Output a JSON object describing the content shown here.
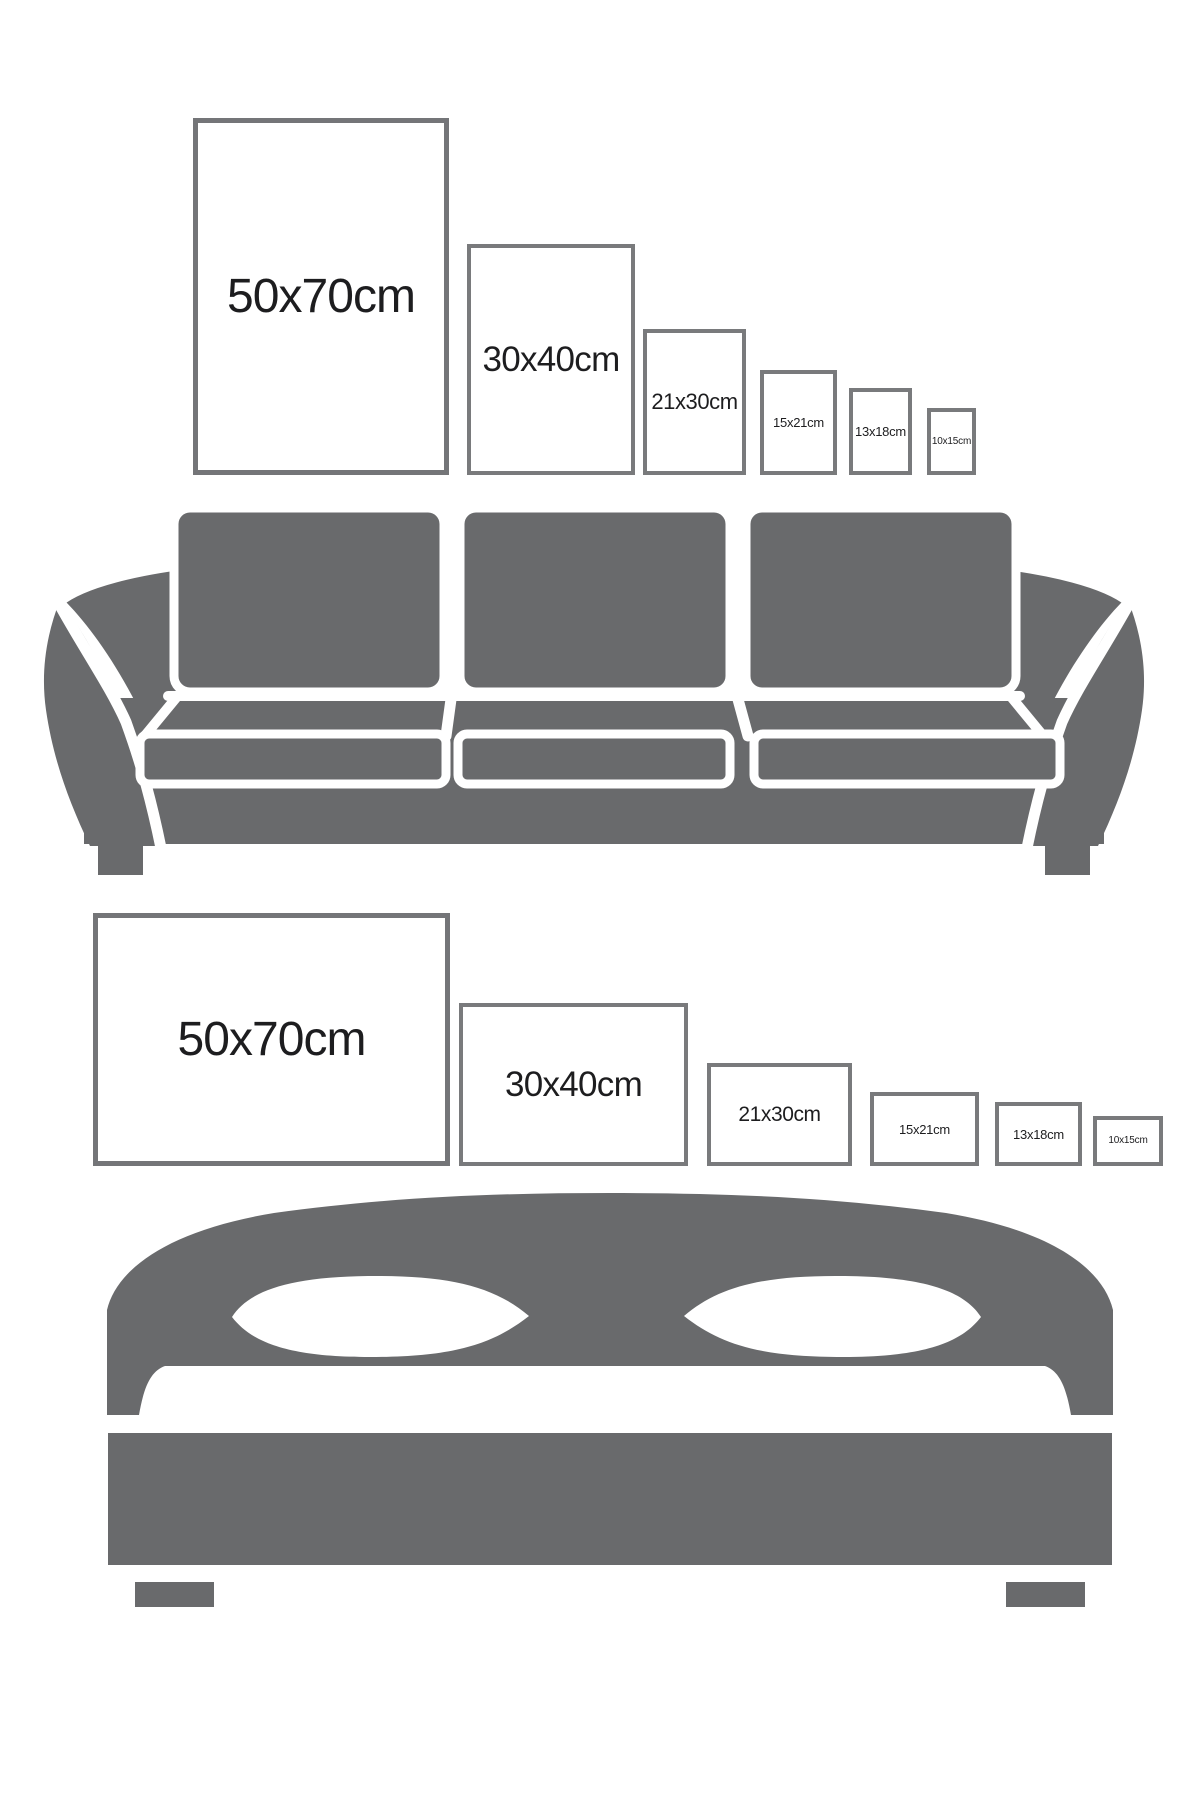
{
  "colors": {
    "background": "#ffffff",
    "silhouette_gray": "#696a6c",
    "frame_border": "#797a7c",
    "large_frame_border": "#747578",
    "label_text": "#1d1d1f"
  },
  "sofa_row": {
    "orientation": "portrait",
    "frames": [
      {
        "label": "50x70cm"
      },
      {
        "label": "30x40cm"
      },
      {
        "label": "21x30cm"
      },
      {
        "label": "15x21cm"
      },
      {
        "label": "13x18cm"
      },
      {
        "label": "10x15cm"
      }
    ]
  },
  "bed_row": {
    "orientation": "landscape",
    "frames": [
      {
        "label": "50x70cm"
      },
      {
        "label": "30x40cm"
      },
      {
        "label": "21x30cm"
      },
      {
        "label": "15x21cm"
      },
      {
        "label": "13x18cm"
      },
      {
        "label": "10x15cm"
      }
    ]
  }
}
